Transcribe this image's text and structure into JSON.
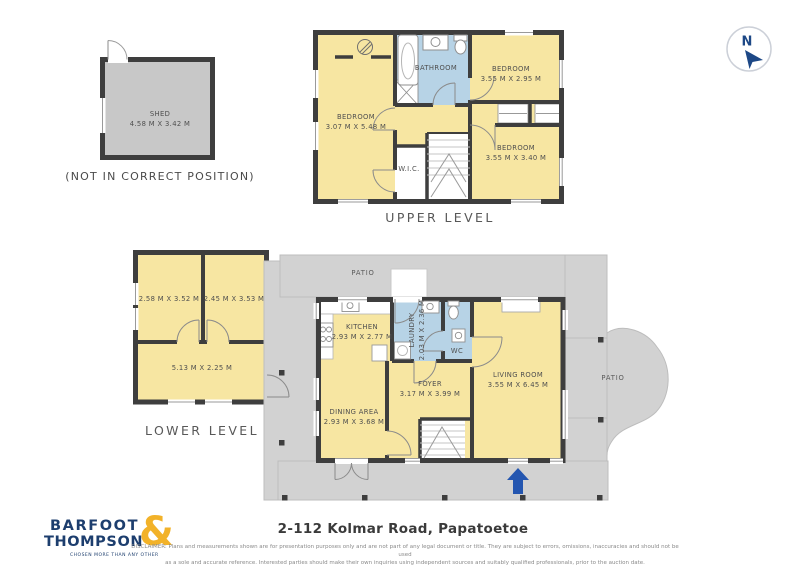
{
  "colors": {
    "room_yellow": "#f7e6a2",
    "wet_blue": "#b7d3e6",
    "wall": "#3e3e3e",
    "patio_gray": "#d2d2d2",
    "shed_gray": "#c8c8c8",
    "logo_navy": "#1d3e6e",
    "logo_gold": "#f2b229",
    "entrance_arrow_blue": "#2456b0"
  },
  "compass": {
    "label": "N"
  },
  "shed": {
    "name": "SHED",
    "dims": "4.58 M X 3.42 M",
    "note": "(NOT IN CORRECT POSITION)"
  },
  "upper_level": {
    "label": "UPPER LEVEL",
    "rooms": {
      "bedroom_left": {
        "name": "BEDROOM",
        "dims": "3.07 M X 5.48 M"
      },
      "bedroom_top_right": {
        "name": "BEDROOM",
        "dims": "3.55 M X 2.95 M"
      },
      "bedroom_bottom_right": {
        "name": "BEDROOM",
        "dims": "3.55 M X 3.40 M"
      },
      "bathroom": {
        "name": "BATHROOM"
      },
      "wic": {
        "name": "W.I.C."
      }
    }
  },
  "lower_level": {
    "label": "LOWER LEVEL",
    "rooms": {
      "room_top_left": {
        "dims": "2.58 M X 3.52 M"
      },
      "room_top_right": {
        "dims": "2.45 M X 3.53 M"
      },
      "room_bottom": {
        "dims": "5.13 M X 2.25 M"
      }
    }
  },
  "main_level": {
    "rooms": {
      "kitchen": {
        "name": "KITCHEN",
        "dims": "2.93 M X 2.77 M"
      },
      "laundry": {
        "name": "LAUNDRY",
        "dims": "2.03 M X 2.36 M"
      },
      "wc": {
        "name": "WC"
      },
      "living_room": {
        "name": "LIVING ROOM",
        "dims": "3.55 M X 6.45 M"
      },
      "foyer": {
        "name": "FOYER",
        "dims": "3.17 M X 3.99 M"
      },
      "dining_area": {
        "name": "DINING AREA",
        "dims": "2.93 M X 3.68 M"
      },
      "patio_top": {
        "name": "PATIO"
      },
      "patio_right": {
        "name": "PATIO"
      }
    }
  },
  "footer": {
    "logo_line1": "BARFOOT",
    "logo_line2": "THOMPSON",
    "logo_amp": "&",
    "logo_tagline": "CHOSEN MORE THAN ANY OTHER",
    "address": "2-112 Kolmar Road, Papatoetoe",
    "disclaimer_line1": "DISCLAIMER: Plans and measurements shown are for presentation purposes only and are not part of any legal document or title. They are subject to errors, omissions, inaccuracies and should not be used",
    "disclaimer_line2": "as a sole and accurate reference. Interested parties should make their own inquiries using independent sources and suitably qualified professionals, prior to the auction date."
  }
}
